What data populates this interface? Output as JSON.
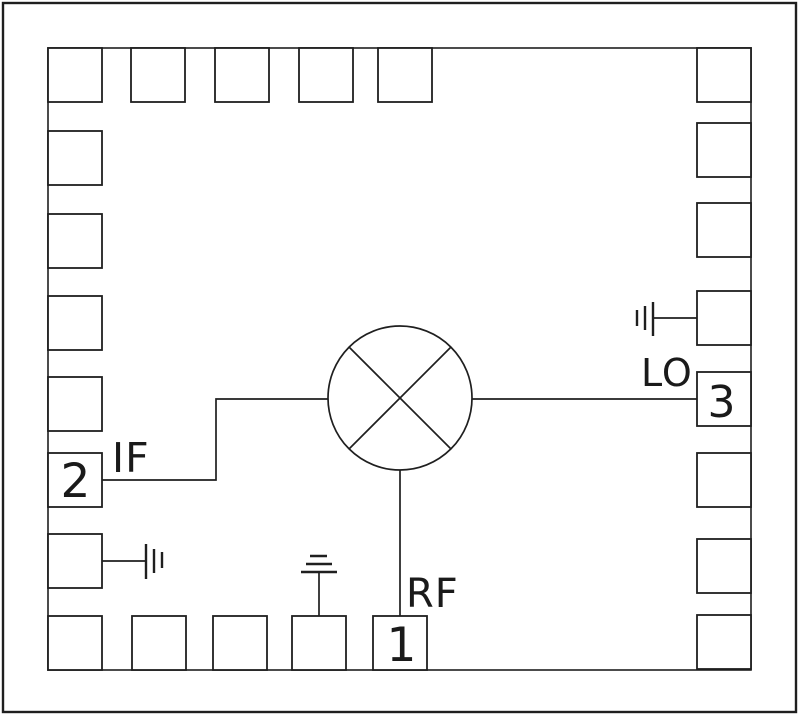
{
  "title": "Mixer IC package bonding diagram",
  "colors": {
    "background": "#ffffff",
    "line": "#1f1f1f",
    "text": "#1a1a1a"
  },
  "labels": {
    "if_port": "IF",
    "lo_port": "LO",
    "rf_port": "RF",
    "pin1": "1",
    "pin2": "2",
    "pin3": "3"
  },
  "ports": [
    {
      "pin": "1",
      "label": "RF",
      "side": "bottom"
    },
    {
      "pin": "2",
      "label": "IF",
      "side": "left"
    },
    {
      "pin": "3",
      "label": "LO",
      "side": "right"
    }
  ],
  "geometry": {
    "outer_border": {
      "x": 3,
      "y": 3,
      "width": 793,
      "height": 709
    },
    "chip_outline": {
      "x": 48,
      "y": 48,
      "width": 703,
      "height": 622
    },
    "pad_size": 54,
    "pads": {
      "top_y": 48,
      "top_xs": [
        48,
        131,
        215,
        299,
        378,
        697
      ],
      "left_x": 48,
      "left_ys": [
        131,
        214,
        296,
        377,
        453,
        534,
        616
      ],
      "right_x": 697,
      "right_ys": [
        123,
        203,
        291,
        372,
        453,
        539,
        615
      ],
      "bottom_y": 616,
      "bottom_xs": [
        132,
        213,
        292,
        373
      ]
    },
    "pin_pads": {
      "pin2_if": {
        "side": "left",
        "y": 453
      },
      "pin3_lo": {
        "side": "right",
        "y": 372
      },
      "pin1_rf": {
        "side": "bottom",
        "x": 373
      }
    },
    "mixer": {
      "cx": 400,
      "cy": 398,
      "r": 72,
      "cross_offset": 51
    },
    "wires": [
      {
        "name": "if-trace",
        "points": "102,480 216,480 216,399 328,399"
      },
      {
        "name": "lo-trace",
        "points": "472,399 697,399"
      },
      {
        "name": "rf-trace",
        "points": "400,470 400,616"
      },
      {
        "name": "ground-left-trace",
        "points": "102,561 146,561"
      },
      {
        "name": "ground-right-trace",
        "points": "697,318 653,318"
      },
      {
        "name": "ground-bottom-trace",
        "points": "319,616 319,572"
      }
    ],
    "ground_symbols": [
      {
        "name": "ground-symbol-left",
        "segments": [
          [
            146,
            544,
            146,
            579
          ],
          [
            154,
            549,
            154,
            573
          ],
          [
            162,
            552,
            162,
            568
          ]
        ]
      },
      {
        "name": "ground-symbol-right",
        "segments": [
          [
            653,
            302,
            653,
            336
          ],
          [
            645,
            306,
            645,
            330
          ],
          [
            637,
            310,
            637,
            326
          ]
        ]
      },
      {
        "name": "ground-symbol-bottom",
        "segments": [
          [
            301,
            572,
            337,
            572
          ],
          [
            306,
            564,
            332,
            564
          ],
          [
            310,
            556,
            327,
            556
          ]
        ]
      }
    ],
    "label_positions": {
      "if_port": {
        "x": 112,
        "y": 472,
        "size": 41,
        "anchor": "start"
      },
      "lo_port": {
        "x": 641,
        "y": 386,
        "size": 38,
        "anchor": "start"
      },
      "rf_port": {
        "x": 406,
        "y": 607,
        "size": 40,
        "anchor": "start"
      },
      "pin2": {
        "x": 76,
        "y": 497,
        "size": 47,
        "anchor": "middle"
      },
      "pin3": {
        "x": 722,
        "y": 417,
        "size": 44,
        "anchor": "middle"
      },
      "pin1": {
        "x": 402,
        "y": 661,
        "size": 47,
        "anchor": "middle"
      }
    }
  }
}
